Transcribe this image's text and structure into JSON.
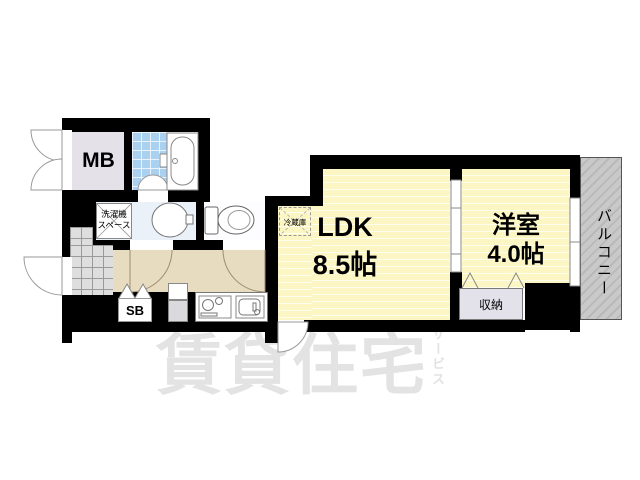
{
  "floorplan": {
    "rooms": {
      "mb": {
        "label": "MB"
      },
      "washer_space": {
        "line1": "洗濯機",
        "line2": "スペース"
      },
      "fridge": {
        "label": "冷蔵庫"
      },
      "ldk": {
        "name": "LDK",
        "size": "8.5帖"
      },
      "western": {
        "name": "洋室",
        "size": "4.0帖"
      },
      "balcony": {
        "label": "バルコニー"
      },
      "closet": {
        "label": "収納"
      },
      "shoebox": {
        "label": "SB"
      }
    },
    "watermark": {
      "main": "賃貸住宅",
      "sub": "サービス"
    },
    "colors": {
      "wall": "#000000",
      "room_yellow": "#fcf6c5",
      "hallway_beige": "#e8dcc0",
      "tile_blue": "#abd1f0",
      "washroom_blue": "#eaf1f8",
      "balcony_gray": "#c9c9c9",
      "mb_gray": "#e4e2e8",
      "closet_gray": "#e3e1ea",
      "entrance_tile": "#dedede",
      "watermark_gray": "#e3e3e3"
    }
  }
}
